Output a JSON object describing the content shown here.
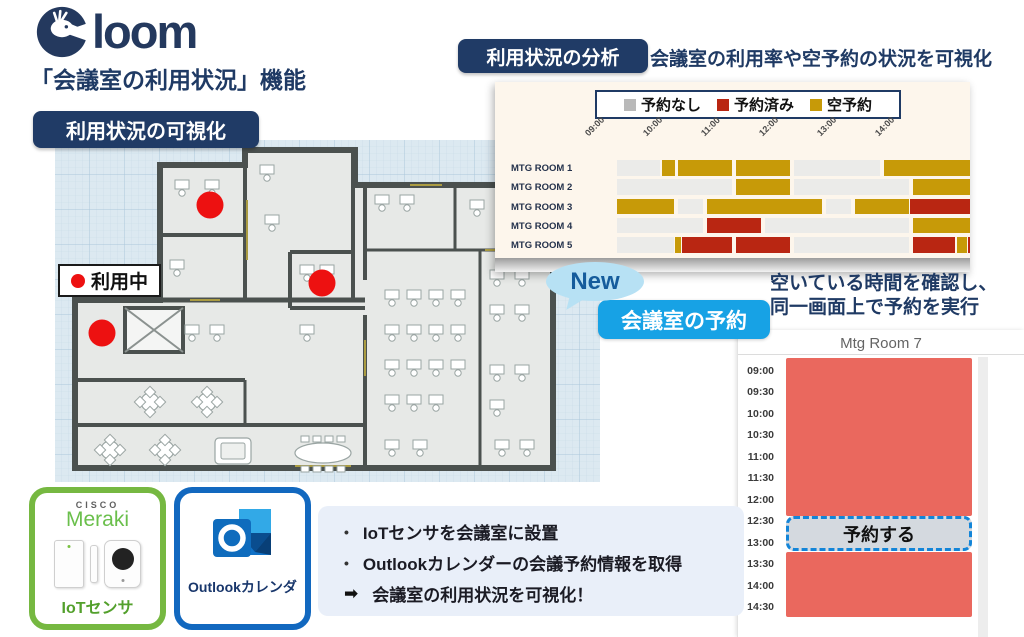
{
  "logo": {
    "name": "Cloom",
    "suffix": "loom"
  },
  "subtitle": "「会議室の利用状況」機能",
  "badges": {
    "visualization": "利用状況の可視化",
    "analysis": "利用状況の分析",
    "new": "New",
    "reserve": "会議室の予約"
  },
  "captions": {
    "analysis": "会議室の利用率や空予約の状況を可視化",
    "reserve_line1": "空いている時間を確認し、",
    "reserve_line2": "同一画面上で予約を実行"
  },
  "floorplan": {
    "legend_label": "利用中",
    "occupied_dots": [
      {
        "x_pct": 28.4,
        "y_pct": 19.0
      },
      {
        "x_pct": 49.0,
        "y_pct": 41.8
      },
      {
        "x_pct": 8.6,
        "y_pct": 56.4
      }
    ]
  },
  "chart_data": {
    "type": "gantt",
    "title": "",
    "legend": [
      {
        "key": "none",
        "label": "予約なし",
        "color": "#b9b9b9"
      },
      {
        "key": "booked",
        "label": "予約済み",
        "color": "#b92612"
      },
      {
        "key": "ghost",
        "label": "空予約",
        "color": "#c79a08"
      }
    ],
    "colors": {
      "none": "#ebebe9",
      "booked": "#b92612",
      "ghost": "#c79a08"
    },
    "x_ticks": [
      "09:00",
      "10:00",
      "11:00",
      "12:00",
      "13:00",
      "14:00"
    ],
    "x_range_hours": [
      9.0,
      15.1
    ],
    "rooms": [
      {
        "name": "MTG ROOM 1",
        "segments": [
          {
            "s": 9.0,
            "e": 9.75,
            "t": "none"
          },
          {
            "s": 9.77,
            "e": 10.02,
            "t": "ghost"
          },
          {
            "s": 10.05,
            "e": 11.0,
            "t": "ghost"
          },
          {
            "s": 11.05,
            "e": 12.0,
            "t": "ghost"
          },
          {
            "s": 12.05,
            "e": 13.55,
            "t": "none"
          },
          {
            "s": 13.6,
            "e": 15.1,
            "t": "ghost"
          }
        ]
      },
      {
        "name": "MTG ROOM 2",
        "segments": [
          {
            "s": 9.0,
            "e": 11.0,
            "t": "none"
          },
          {
            "s": 11.05,
            "e": 12.0,
            "t": "ghost"
          },
          {
            "s": 12.05,
            "e": 14.05,
            "t": "none"
          },
          {
            "s": 14.1,
            "e": 15.1,
            "t": "ghost"
          }
        ]
      },
      {
        "name": "MTG ROOM 3",
        "segments": [
          {
            "s": 9.0,
            "e": 10.0,
            "t": "ghost"
          },
          {
            "s": 10.05,
            "e": 10.5,
            "t": "none"
          },
          {
            "s": 10.55,
            "e": 12.55,
            "t": "ghost"
          },
          {
            "s": 12.6,
            "e": 13.05,
            "t": "none"
          },
          {
            "s": 13.1,
            "e": 14.05,
            "t": "ghost"
          },
          {
            "s": 14.05,
            "e": 15.1,
            "t": "booked"
          }
        ]
      },
      {
        "name": "MTG ROOM 4",
        "segments": [
          {
            "s": 9.0,
            "e": 10.5,
            "t": "none"
          },
          {
            "s": 10.55,
            "e": 11.5,
            "t": "booked"
          },
          {
            "s": 11.55,
            "e": 14.05,
            "t": "none"
          },
          {
            "s": 14.1,
            "e": 15.1,
            "t": "ghost"
          }
        ]
      },
      {
        "name": "MTG ROOM 5",
        "segments": [
          {
            "s": 9.0,
            "e": 10.0,
            "t": "none"
          },
          {
            "s": 10.0,
            "e": 10.12,
            "t": "ghost"
          },
          {
            "s": 10.12,
            "e": 11.0,
            "t": "booked"
          },
          {
            "s": 11.05,
            "e": 12.0,
            "t": "booked"
          },
          {
            "s": 12.05,
            "e": 14.05,
            "t": "none"
          },
          {
            "s": 14.1,
            "e": 14.85,
            "t": "booked"
          },
          {
            "s": 14.87,
            "e": 15.05,
            "t": "ghost"
          },
          {
            "s": 15.05,
            "e": 15.1,
            "t": "booked"
          }
        ]
      }
    ]
  },
  "booking": {
    "room_title": "Mtg Room 7",
    "times": [
      "09:00",
      "09:30",
      "10:00",
      "10:30",
      "11:00",
      "11:30",
      "12:00",
      "12:30",
      "13:00",
      "13:30",
      "14:00",
      "14:30"
    ],
    "busy_color": "#ea685e",
    "blocks": [
      {
        "from": "09:00",
        "to": "12:30",
        "type": "busy"
      },
      {
        "from": "12:30",
        "to": "13:00",
        "type": "bookable",
        "label": "予約する"
      },
      {
        "from": "13:00",
        "to": "14:30",
        "type": "busy"
      }
    ]
  },
  "cards": {
    "meraki": {
      "brand_top": "CISCO",
      "brand": "Meraki",
      "label": "IoTセンサ"
    },
    "outlook": {
      "label": "Outlookカレンダ"
    }
  },
  "bullets": {
    "items": [
      "IoTセンサを会議室に設置",
      "Outlookカレンダーの会議予約情報を取得"
    ],
    "arrow_item": "会議室の利用状況を可視化！"
  }
}
